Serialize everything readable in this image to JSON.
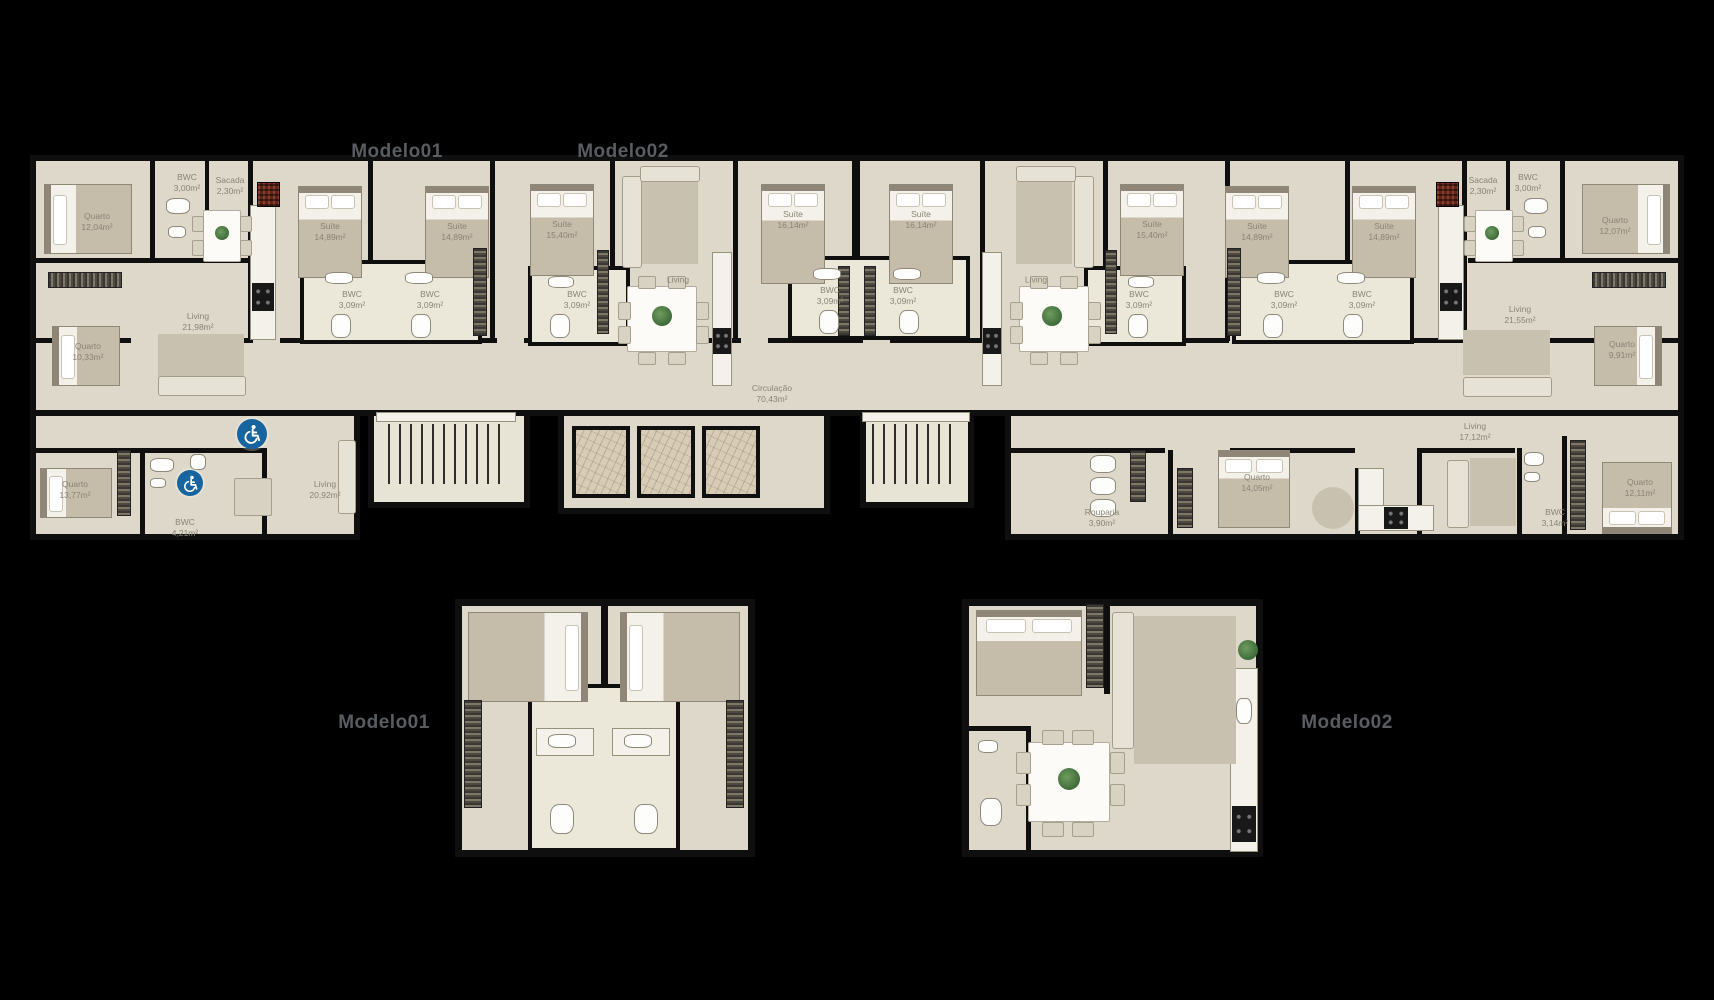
{
  "plan": {
    "titles": [
      {
        "label": "Modelo01",
        "x": 397,
        "y": 152
      },
      {
        "label": "Modelo02",
        "x": 623,
        "y": 152
      },
      {
        "label": "Modelo01",
        "x": 384,
        "y": 723
      },
      {
        "label": "Modelo02",
        "x": 1347,
        "y": 723
      }
    ],
    "rooms": [
      {
        "name": "Quarto",
        "area": "12,04m²",
        "x": 97,
        "y": 222
      },
      {
        "name": "BWC",
        "area": "3,00m²",
        "x": 187,
        "y": 183
      },
      {
        "name": "Sacada",
        "area": "2,30m²",
        "x": 230,
        "y": 186
      },
      {
        "name": "Living",
        "area": "21,98m²",
        "x": 198,
        "y": 322
      },
      {
        "name": "Quarto",
        "area": "10,33m²",
        "x": 88,
        "y": 352
      },
      {
        "name": "Suíte",
        "area": "14,89m²",
        "x": 330,
        "y": 232
      },
      {
        "name": "Suíte",
        "area": "14,89m²",
        "x": 457,
        "y": 232
      },
      {
        "name": "BWC",
        "area": "3,09m²",
        "x": 352,
        "y": 300
      },
      {
        "name": "BWC",
        "area": "3,09m²",
        "x": 430,
        "y": 300
      },
      {
        "name": "Suíte",
        "area": "15,40m²",
        "x": 562,
        "y": 230
      },
      {
        "name": "BWC",
        "area": "3,09m²",
        "x": 577,
        "y": 300
      },
      {
        "name": "Living",
        "area": "",
        "x": 678,
        "y": 280
      },
      {
        "name": "Suíte",
        "area": "16,14m²",
        "x": 793,
        "y": 220
      },
      {
        "name": "BWC",
        "area": "3,09m²",
        "x": 830,
        "y": 296
      },
      {
        "name": "BWC",
        "area": "3,09m²",
        "x": 903,
        "y": 296
      },
      {
        "name": "Suíte",
        "area": "16,14m²",
        "x": 921,
        "y": 220
      },
      {
        "name": "Living",
        "area": "",
        "x": 1036,
        "y": 280
      },
      {
        "name": "BWC",
        "area": "3,09m²",
        "x": 1139,
        "y": 300
      },
      {
        "name": "Suíte",
        "area": "15,40m²",
        "x": 1152,
        "y": 230
      },
      {
        "name": "BWC",
        "area": "3,09m²",
        "x": 1284,
        "y": 300
      },
      {
        "name": "Suíte",
        "area": "14,89m²",
        "x": 1257,
        "y": 232
      },
      {
        "name": "BWC",
        "area": "3,09m²",
        "x": 1362,
        "y": 300
      },
      {
        "name": "Suíte",
        "area": "14,89m²",
        "x": 1384,
        "y": 232
      },
      {
        "name": "Sacada",
        "area": "2,30m²",
        "x": 1483,
        "y": 186
      },
      {
        "name": "BWC",
        "area": "3,00m²",
        "x": 1528,
        "y": 183
      },
      {
        "name": "Quarto",
        "area": "12,07m²",
        "x": 1615,
        "y": 226
      },
      {
        "name": "Living",
        "area": "21,55m²",
        "x": 1520,
        "y": 315
      },
      {
        "name": "Quarto",
        "area": "9,91m²",
        "x": 1622,
        "y": 350
      },
      {
        "name": "Circulação",
        "area": "70,43m²",
        "x": 772,
        "y": 394
      },
      {
        "name": "Quarto",
        "area": "13,77m²",
        "x": 75,
        "y": 490
      },
      {
        "name": "BWC",
        "area": "4,21m²",
        "x": 185,
        "y": 528
      },
      {
        "name": "Living",
        "area": "20,92m²",
        "x": 325,
        "y": 490
      },
      {
        "name": "Rouparia",
        "area": "3,90m²",
        "x": 1102,
        "y": 518
      },
      {
        "name": "Quarto",
        "area": "14,05m²",
        "x": 1257,
        "y": 483
      },
      {
        "name": "Living",
        "area": "17,12m²",
        "x": 1475,
        "y": 432
      },
      {
        "name": "BWC",
        "area": "3,14m²",
        "x": 1555,
        "y": 518
      },
      {
        "name": "Quarto",
        "area": "12,11m²",
        "x": 1640,
        "y": 488
      }
    ],
    "accessibility_icons": [
      {
        "icon": "wheelchair-accessible-icon",
        "x": 252,
        "y": 434,
        "d": 30
      },
      {
        "icon": "wheelchair-accessible-icon",
        "x": 190,
        "y": 483,
        "d": 26
      }
    ],
    "colors": {
      "background": "#000000",
      "floor": "#ddd8c9",
      "wall": "#0f0f0f",
      "label_text": "#8a8476",
      "title_text": "#595c60",
      "accessibility_blue": "#17649f"
    }
  }
}
